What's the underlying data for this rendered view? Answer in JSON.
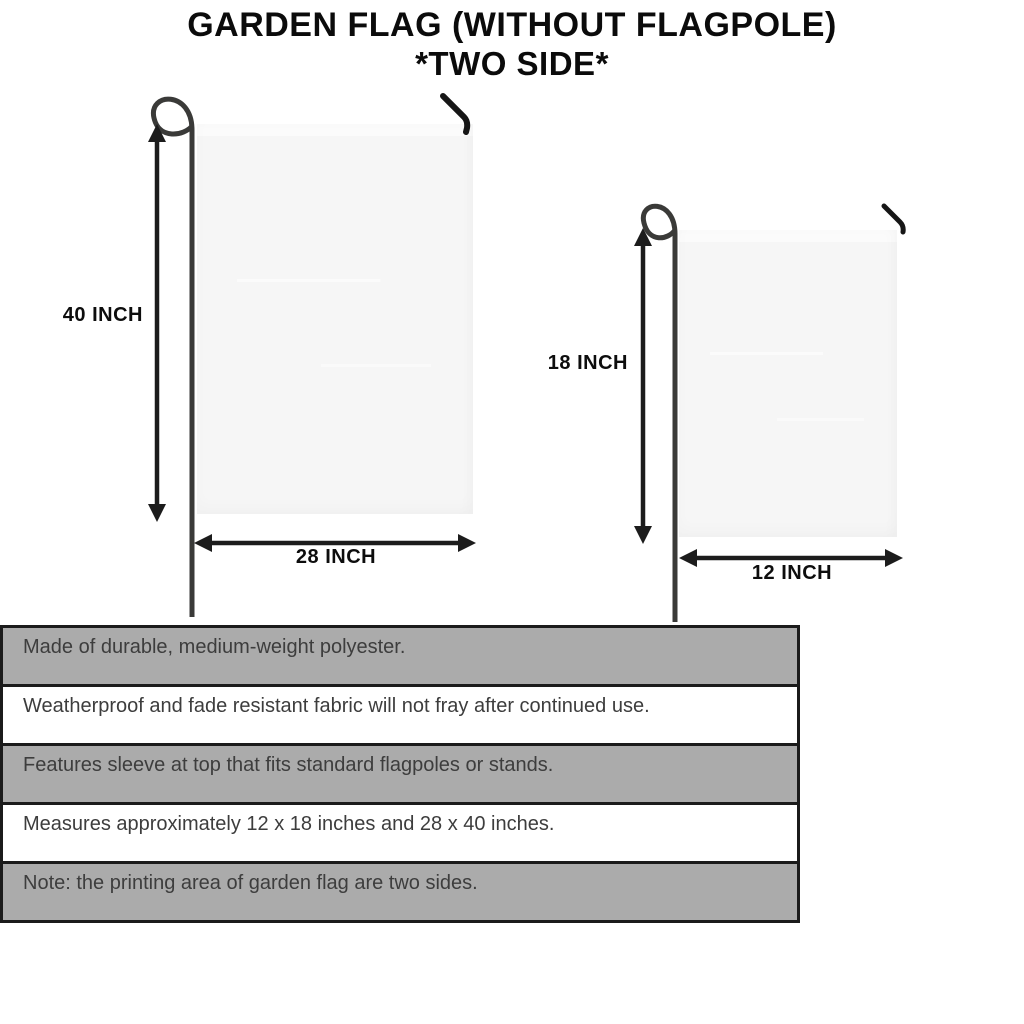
{
  "title": {
    "line1": "GARDEN FLAG (WITHOUT FLAGPOLE)",
    "line2": "*TWO SIDE*"
  },
  "large_flag": {
    "height_label": "40 INCH",
    "width_label": "28 INCH"
  },
  "small_flag": {
    "height_label": "18 INCH",
    "width_label": "12 INCH"
  },
  "spec_table": {
    "rows": [
      {
        "text": "Made of durable, medium-weight polyester.",
        "shaded": true
      },
      {
        "text": "Weatherproof and fade resistant fabric will not fray after continued use.",
        "shaded": false
      },
      {
        "text": "Features sleeve at top that fits standard flagpoles or stands.",
        "shaded": true
      },
      {
        "text": "Measures approximately 12 x 18 inches and 28 x 40 inches.",
        "shaded": false
      },
      {
        "text": "Note: the printing area of garden flag are two sides.",
        "shaded": true
      }
    ]
  },
  "icons": {
    "pole_loop": "pole-loop-icon",
    "hanger_hook": "hanger-hook-icon",
    "dimension_arrow": "dimension-arrow-icon"
  },
  "colors": {
    "row_shaded": "#ababab",
    "table_border": "#1b1b1b",
    "flag_fill": "#f6f6f6",
    "table_text": "#3d3d3d",
    "title_text": "#0b0b0b"
  }
}
